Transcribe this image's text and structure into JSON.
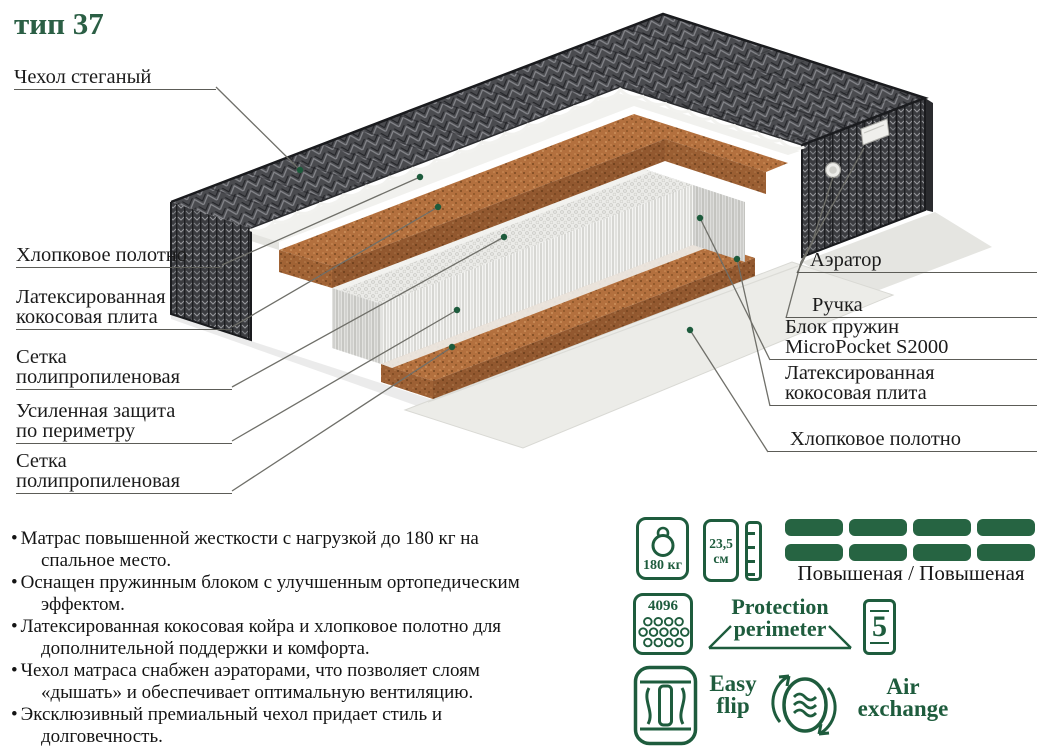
{
  "title": "тип 37",
  "labels": {
    "left": [
      {
        "lines": [
          "Чехол стеганый"
        ]
      },
      {
        "lines": [
          "Хлопковое полотно"
        ]
      },
      {
        "lines": [
          "Латексированная",
          "кокосовая плита"
        ]
      },
      {
        "lines": [
          "Сетка",
          "полипропиленовая"
        ]
      },
      {
        "lines": [
          "Усиленная защита",
          "по периметру"
        ]
      },
      {
        "lines": [
          "Сетка",
          "полипропиленовая"
        ]
      }
    ],
    "right": [
      {
        "lines": [
          "Аэратор"
        ]
      },
      {
        "lines": [
          "Ручка"
        ]
      },
      {
        "lines": [
          "Блок пружин",
          "MicroPocket S2000"
        ]
      },
      {
        "lines": [
          "Латексированная",
          "кокосовая плита"
        ]
      },
      {
        "lines": [
          "Хлопковое полотно"
        ]
      }
    ]
  },
  "bullets": [
    "Матрас повышенной жесткости с нагрузкой до 180 кг на спальное место.",
    "Оснащен пружинным блоком с улучшенным ортопедическим эффектом.",
    "Латексированная кокосовая койра и хлопковое полотно для дополнительной поддержки и комфорта.",
    "Чехол матраса снабжен аэраторами, что позволяет слоям «дышать» и обеспечивает оптимальную вентиляцию.",
    "Эксклюзивный премиальный чехол придает стиль и долговечность."
  ],
  "badges": {
    "weight": {
      "value": "180 кг"
    },
    "height": {
      "lines": [
        "23,5",
        "см"
      ]
    },
    "firmness": {
      "label": "Повышеная / Повышеная"
    },
    "springs_count": {
      "value": "4096"
    },
    "protection": {
      "lines": [
        "Protection",
        "perimeter"
      ]
    },
    "zones": {
      "value": "5"
    },
    "easy_flip": {
      "lines": [
        "Easy",
        "flip"
      ]
    },
    "air_exchange": {
      "lines": [
        "Air",
        "exchange"
      ]
    }
  },
  "colors": {
    "accent_green": "#1e5c3d",
    "cover_dark": "#4a4b4f",
    "coir_brown": "#b3703e",
    "spring_white": "#f5f5f3"
  }
}
